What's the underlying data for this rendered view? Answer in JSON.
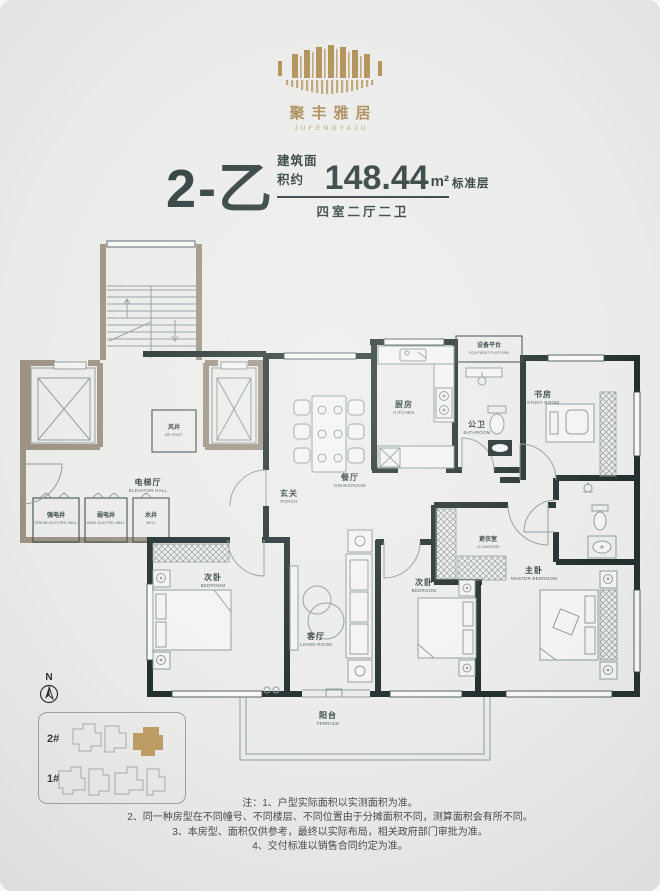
{
  "logo": {
    "brand_zh": "聚丰雅居",
    "brand_en": "JUFENGYAJU",
    "gold": "#b29259"
  },
  "title": {
    "unit": "2-乙",
    "area_label": "建筑面积约",
    "area_value": "148.44",
    "area_unit": "m²",
    "rooms_spec": "四室二厅二卫",
    "floor_note": "标准层"
  },
  "plan": {
    "wall_dark": "#22302f",
    "wall_gray": "#9d9384",
    "rooms": [
      {
        "zh": "风井",
        "en": "AIR SHAFT"
      },
      {
        "zh": "电梯厅",
        "en": "ELEVATOR HALL"
      },
      {
        "zh": "强电井",
        "en": "STRONG ELECTRIC WELL"
      },
      {
        "zh": "弱电井",
        "en": "WEAK ELECTRIC WELL"
      },
      {
        "zh": "水井",
        "en": "WELL"
      },
      {
        "zh": "玄关",
        "en": "PORCH"
      },
      {
        "zh": "餐厅",
        "en": "DININGROOM"
      },
      {
        "zh": "厨房",
        "en": "KITCHEN"
      },
      {
        "zh": "公卫",
        "en": "BATHROOM"
      },
      {
        "zh": "设备平台",
        "en": "EQUIPMENT PLATFORM"
      },
      {
        "zh": "书房",
        "en": "STUDY ROOM"
      },
      {
        "zh": "更衣室",
        "en": "CLOAKROOM"
      },
      {
        "zh": "主卧",
        "en": "MASTER BEDROOM"
      },
      {
        "zh": "次卧",
        "en": "BEDROOM"
      },
      {
        "zh": "次卧",
        "en": "BEDROOM"
      },
      {
        "zh": "客厅",
        "en": "LIVING ROOM"
      },
      {
        "zh": "阳台",
        "en": "TERRACE"
      }
    ]
  },
  "compass": {
    "label": "N"
  },
  "site_plan": {
    "building_2": "2#",
    "building_1": "1#",
    "highlight_color": "#bf9e64"
  },
  "notes": {
    "lines": [
      "注：1、户型实际面积以实测面积为准。",
      "2、同一种房型在不同幢号、不同楼层、不同位置由于分摊面积不同，测算面积会有所不同。",
      "3、本房型、面积仅供参考，最终以实际布局，相关政府部门审批为准。",
      "4、交付标准以销售合同约定为准。"
    ]
  }
}
